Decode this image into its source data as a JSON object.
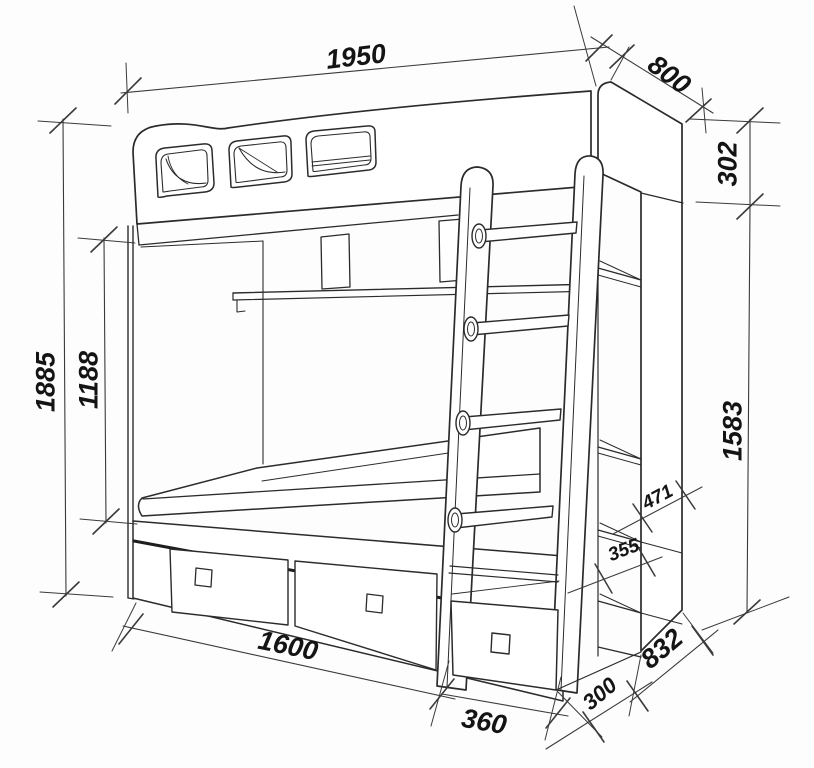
{
  "drawing": {
    "subject": "loft-bunk-bed-technical-drawing",
    "line_color": "#2b2b2b",
    "dim_color": "#3a3a3a",
    "background": "#fdfdfd"
  },
  "dimensions": {
    "overall_length": "1950",
    "overall_depth": "800",
    "guard_rail_height": "302",
    "overall_height": "1885",
    "bunk_clearance_height": "1188",
    "side_unit_height": "1583",
    "shelf_spacing_upper": "471",
    "shelf_spacing_lower": "355",
    "bed_length": "1600",
    "ladder_cabinet_width": "360",
    "shelf_unit_depth": "300",
    "base_unit_length": "832"
  }
}
